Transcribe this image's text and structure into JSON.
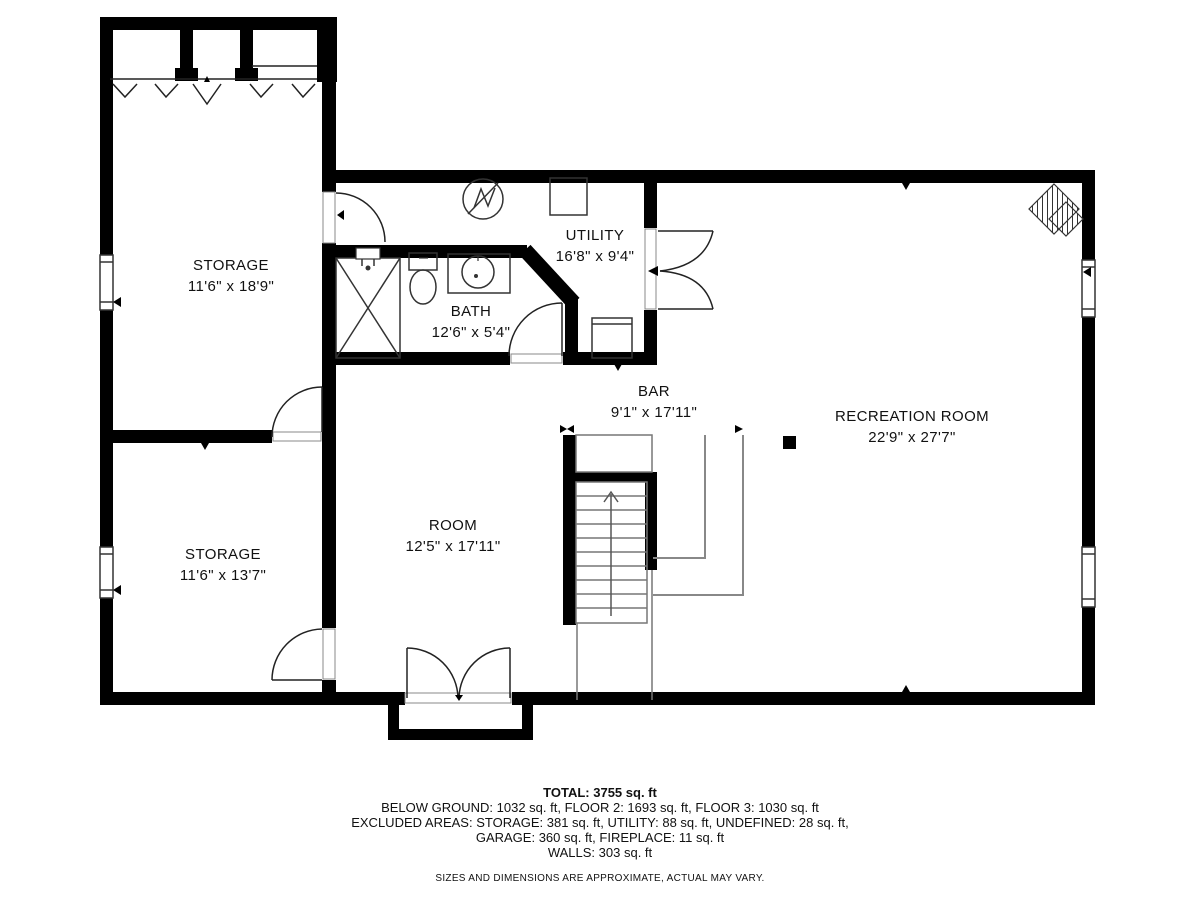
{
  "rooms": {
    "storage_upper": {
      "name": "STORAGE",
      "dims": "11'6\" x 18'9\""
    },
    "bath": {
      "name": "BATH",
      "dims": "12'6\" x 5'4\""
    },
    "utility": {
      "name": "UTILITY",
      "dims": "16'8\" x 9'4\""
    },
    "bar": {
      "name": "BAR",
      "dims": "9'1\" x 17'11\""
    },
    "recreation": {
      "name": "RECREATION ROOM",
      "dims": "22'9\" x 27'7\""
    },
    "room": {
      "name": "ROOM",
      "dims": "12'5\" x 17'11\""
    },
    "storage_lower": {
      "name": "STORAGE",
      "dims": "11'6\" x 13'7\""
    }
  },
  "summary": {
    "total": "TOTAL: 3755 sq. ft",
    "floors": "BELOW GROUND: 1032 sq. ft, FLOOR 2: 1693 sq. ft, FLOOR 3: 1030 sq. ft",
    "excluded1": "EXCLUDED AREAS: STORAGE: 381 sq. ft, UTILITY: 88 sq. ft, UNDEFINED: 28 sq. ft,",
    "excluded2": "GARAGE: 360 sq. ft, FIREPLACE: 11 sq. ft",
    "walls": "WALLS: 303 sq. ft",
    "disclaimer": "SIZES AND DIMENSIONS ARE APPROXIMATE, ACTUAL MAY VARY."
  },
  "colors": {
    "wall": "#000000",
    "thin_line": "#555555",
    "background": "#ffffff"
  }
}
